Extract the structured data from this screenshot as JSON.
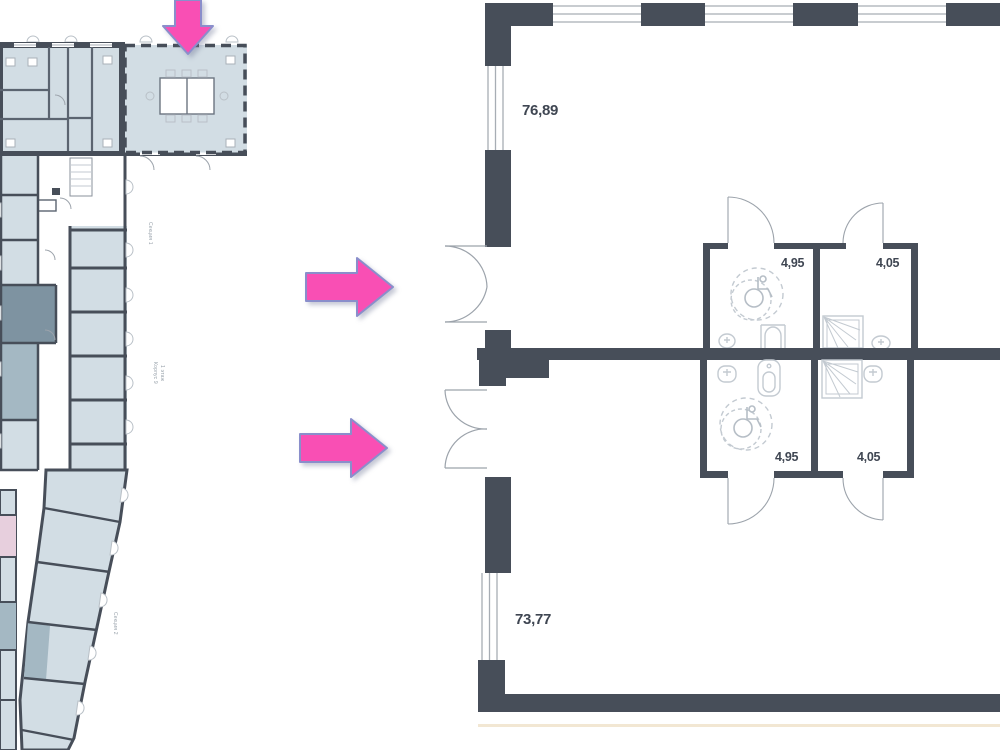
{
  "document": {
    "type": "floor-plan-sheet",
    "description": "Residential floor plate with highlighted unit and two enlarged commercial unit plans"
  },
  "palette": {
    "wall": "#474E59",
    "room_light": "#D2DDE4",
    "room_medium": "#A4B8C3",
    "room_dark": "#7E93A1",
    "room_pink": "#E7CFDD",
    "arrow_fill": "#F94FB4",
    "arrow_stroke": "#8A8ECB",
    "fixture_line": "#C3CAD1",
    "window_line": "#A7ADB4",
    "label_text": "#3F4652",
    "muted_text": "#98A2AB",
    "baseline_cream": "#F2E7D3"
  },
  "site_plan": {
    "section1": "Секция 1",
    "building": "Корпус 9",
    "floor": "1 этаж",
    "section2": "Секция 2"
  },
  "unit_top": {
    "area": "76,89",
    "bath_accessible": "4,95",
    "bath_shower": "4,05"
  },
  "unit_bottom": {
    "area": "73,77",
    "bath_accessible": "4,95",
    "bath_shower": "4,05"
  },
  "icons": [
    "down-arrow-icon",
    "right-arrow-icon",
    "wheelchair-icon",
    "shower-icon",
    "toilet-icon",
    "sink-icon"
  ]
}
